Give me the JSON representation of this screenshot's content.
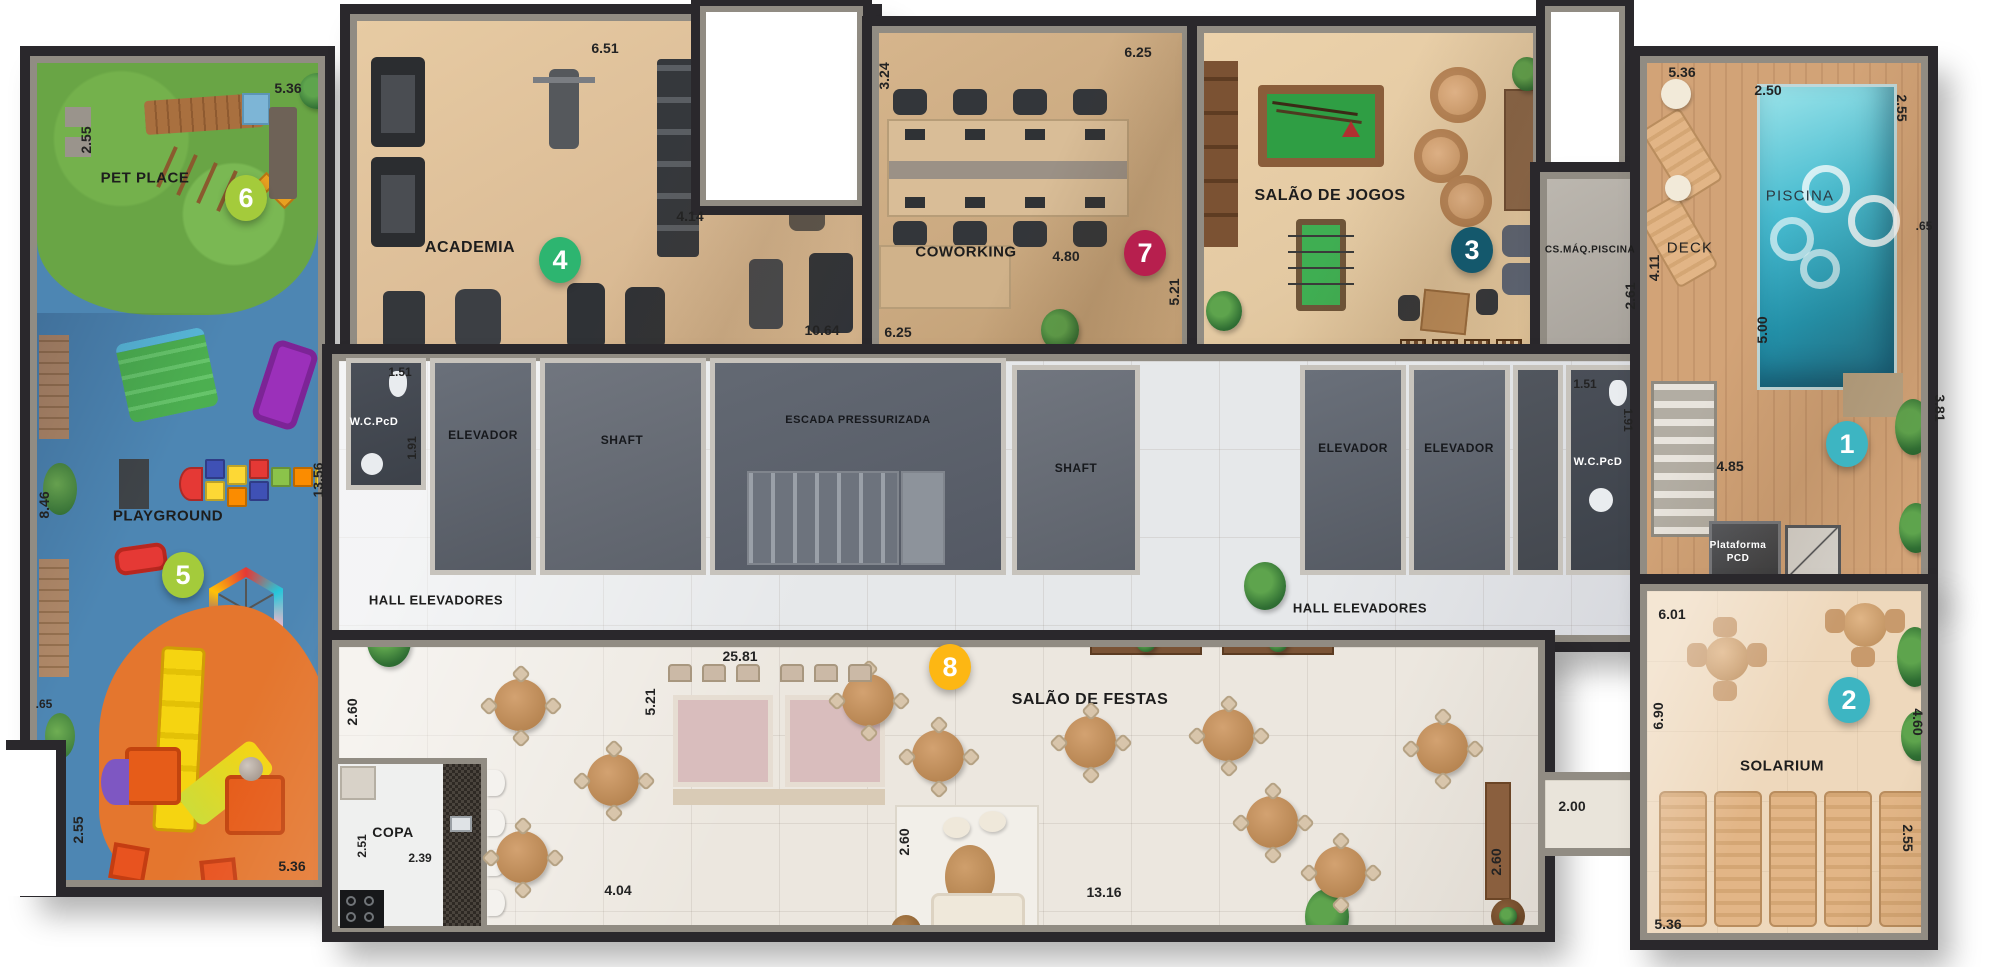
{
  "rooms": {
    "pet_place": {
      "label": "PET PLACE"
    },
    "playground": {
      "label": "PLAYGROUND"
    },
    "academia": {
      "label": "ACADEMIA"
    },
    "coworking": {
      "label": "COWORKING"
    },
    "salao_de_jogos": {
      "label": "SALÃO DE JOGOS"
    },
    "cs_maq_piscina": {
      "label": "CS.MÁQ.PISCINA"
    },
    "piscina": {
      "label": "PISCINA"
    },
    "deck": {
      "label": "DECK"
    },
    "solarium": {
      "label": "SOLARIUM"
    },
    "salao_de_festas": {
      "label": "SALÃO DE FESTAS"
    },
    "copa": {
      "label": "COPA"
    },
    "escada": {
      "label": "ESCADA PRESSURIZADA"
    },
    "hall_left": {
      "label": "HALL ELEVADORES"
    },
    "hall_right": {
      "label": "HALL ELEVADORES"
    },
    "wc_left": {
      "label": "W.C.PcD"
    },
    "wc_right": {
      "label": "W.C.PcD"
    },
    "elevador_a": {
      "label": "ELEVADOR"
    },
    "elevador_b": {
      "label": "ELEVADOR"
    },
    "elevador_c": {
      "label": "ELEVADOR"
    },
    "shaft_left": {
      "label": "SHAFT"
    },
    "shaft_right": {
      "label": "SHAFT"
    },
    "plataforma_pcd": {
      "label": "Plataforma PCD"
    }
  },
  "badges": [
    {
      "number": "1",
      "area": "piscina-deck",
      "color": "#3db5c2"
    },
    {
      "number": "2",
      "area": "solarium",
      "color": "#3db5c2"
    },
    {
      "number": "3",
      "area": "salao-de-jogos",
      "color": "#14586c"
    },
    {
      "number": "4",
      "area": "academia",
      "color": "#2db570"
    },
    {
      "number": "5",
      "area": "playground",
      "color": "#a4cb3b"
    },
    {
      "number": "6",
      "area": "pet-place",
      "color": "#a4cb3b"
    },
    {
      "number": "7",
      "area": "coworking",
      "color": "#b71f4e"
    },
    {
      "number": "8",
      "area": "salao-de-festas",
      "color": "#fdb713"
    }
  ],
  "dims": [
    "2.55",
    "5.36",
    "8.46",
    ".65",
    "2.55",
    "5.36",
    "13.56",
    "6.51",
    "4.14",
    "1.51",
    "1.91",
    "3.24",
    "6.25",
    "4.80",
    "10.64",
    "6.25",
    "5.21",
    "1.51",
    "1.91",
    "2.61",
    "5.36",
    "2.50",
    "2.55",
    ".65",
    "4.11",
    "5.00",
    "4.85",
    "3.81",
    "6.01",
    "6.90",
    "4.60",
    "2.55",
    "5.36",
    "2.00",
    "25.81",
    "5.21",
    "2.60",
    "2.60",
    "2.60",
    "4.04",
    "13.16",
    "2.51",
    "2.39"
  ]
}
